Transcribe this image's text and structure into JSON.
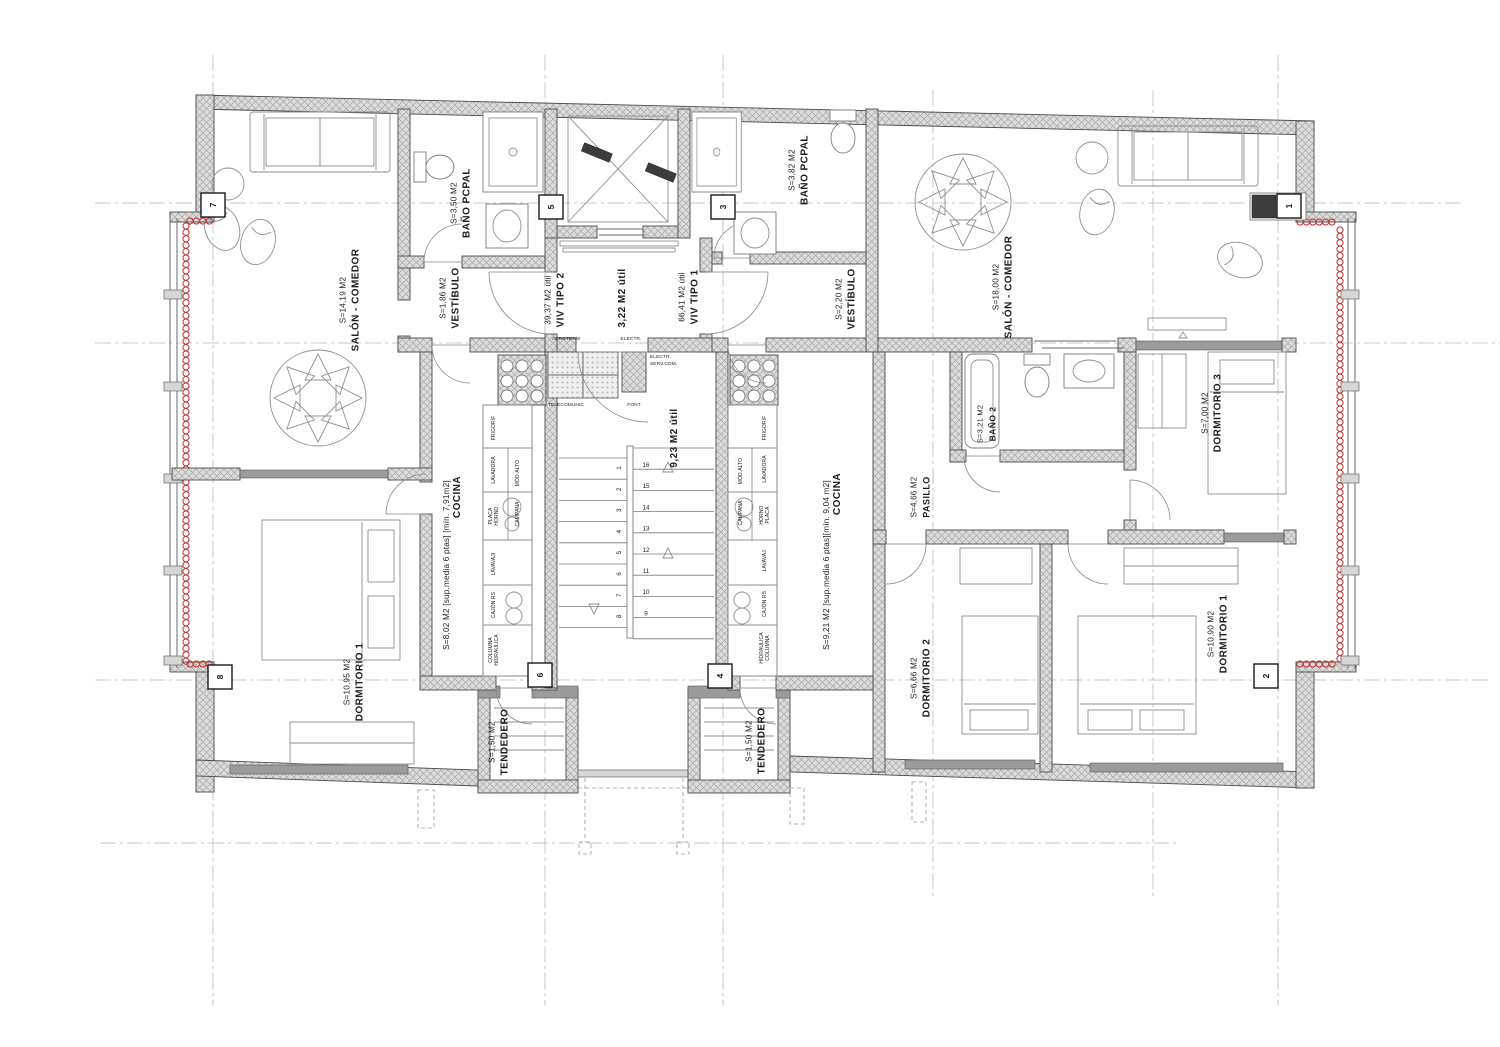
{
  "palette": {
    "background": "#ffffff",
    "wall_grey": "#dcdcdc",
    "line_grey": "#4a4a4a",
    "heating_red": "#c43c39",
    "axis_grey": "#b9b9b9"
  },
  "units": [
    {
      "type_label": "VIV TIPO 2",
      "type_area": "39,37 M2 útil"
    },
    {
      "type_label": "VIV TIPO 1",
      "type_area": "66,41 M2 útil"
    }
  ],
  "room_labels": [
    {
      "name": "SALÓN - COMEDOR",
      "area": "S=14,19 M2",
      "x": 352,
      "y": 300
    },
    {
      "name": "BAÑO PCPAL",
      "area": "S=3,50 M2",
      "x": 463,
      "y": 203
    },
    {
      "name": "VESTÍBULO",
      "area": "S=1,86 M2",
      "x": 452,
      "y": 298
    },
    {
      "name": "COCINA",
      "area": "",
      "x": 460,
      "y": 497
    },
    {
      "name": "",
      "area": "S=8,02 M2 [sup.media 6 ptas] [mín. 7,91m2]",
      "x": 449,
      "y": 565
    },
    {
      "name": "DORMITORIO 1",
      "area": "S=10,95 M2",
      "x": 356,
      "y": 682
    },
    {
      "name": "TENDEDERO",
      "area": "S=1,50 M2",
      "x": 501,
      "y": 742
    },
    {
      "name": "VIV TIPO 2",
      "area": "39,37 M2 útil",
      "x": 557,
      "y": 300
    },
    {
      "name": "3,22 M2 útil",
      "area": "",
      "x": 625,
      "y": 298
    },
    {
      "name": "VIV TIPO 1",
      "area": "66,41 M2 útil",
      "x": 691,
      "y": 297
    },
    {
      "name": "9,23 M2 útil",
      "area": "",
      "x": 677,
      "y": 438
    },
    {
      "name": "BAÑO PCPAL",
      "area": "S=3,82 M2",
      "x": 801,
      "y": 170
    },
    {
      "name": "VESTÍBULO",
      "area": "S=2,20 M2",
      "x": 848,
      "y": 299
    },
    {
      "name": "SALÓN - COMEDOR",
      "area": "S=18,00 M2",
      "x": 1005,
      "y": 287
    },
    {
      "name": "BAÑO 2",
      "area": "S=3,21 M2",
      "x": 989,
      "y": 424,
      "fs": 8.5
    },
    {
      "name": "PASILLO",
      "area": "S=4,66 M2",
      "x": 923,
      "y": 497,
      "fs": 9
    },
    {
      "name": "DORMITORIO 3",
      "area": "S=7,00 M2",
      "x": 1214,
      "y": 413
    },
    {
      "name": "COCINA",
      "area": "",
      "x": 840,
      "y": 494
    },
    {
      "name": "",
      "area": "S=9,21 M2 [sup.media 6 ptas][mín. 9,04 m2]",
      "x": 829,
      "y": 565
    },
    {
      "name": "DORMITORIO 2",
      "area": "S=6,66 M2",
      "x": 923,
      "y": 678
    },
    {
      "name": "DORMITORIO 1",
      "area": "S=10,90 M2",
      "x": 1220,
      "y": 634
    },
    {
      "name": "TENDEDERO",
      "area": "S=1,50 M2",
      "x": 758,
      "y": 741
    }
  ],
  "fixture_labels": [
    {
      "lines": [
        "FRIGORÍF"
      ],
      "x": 495,
      "y": 428
    },
    {
      "lines": [
        "LAVADORA"
      ],
      "x": 495,
      "y": 470
    },
    {
      "lines": [
        "PLACA",
        "HORNO"
      ],
      "x": 495,
      "y": 516
    },
    {
      "lines": [
        "MÓD.ALTO"
      ],
      "x": 519,
      "y": 473
    },
    {
      "lines": [
        "CAMPANA"
      ],
      "x": 519,
      "y": 514
    },
    {
      "lines": [
        "LAVAVAJI"
      ],
      "x": 495,
      "y": 564
    },
    {
      "lines": [
        "CAJÓN RS"
      ],
      "x": 495,
      "y": 605
    },
    {
      "lines": [
        "COLUMNA",
        "HIDRAULICA"
      ],
      "x": 495,
      "y": 650
    },
    {
      "lines": [
        "FRIGORÍF"
      ],
      "x": 766,
      "y": 428
    },
    {
      "lines": [
        "LAVADORA"
      ],
      "x": 766,
      "y": 469
    },
    {
      "lines": [
        "HORNO",
        "PLACA"
      ],
      "x": 766,
      "y": 515
    },
    {
      "lines": [
        "MÓD.ALTO"
      ],
      "x": 742,
      "y": 471
    },
    {
      "lines": [
        "CAMPANA"
      ],
      "x": 742,
      "y": 513
    },
    {
      "lines": [
        "LAVAVAJ."
      ],
      "x": 766,
      "y": 560
    },
    {
      "lines": [
        "CAJÓN RS"
      ],
      "x": 766,
      "y": 604
    },
    {
      "lines": [
        "HIDRAULICA",
        "COLUMNA"
      ],
      "x": 766,
      "y": 648
    }
  ],
  "closet_labels": [
    {
      "text": "AEROTERM",
      "x": 566,
      "y": 340
    },
    {
      "text": "ELECTR.",
      "x": 631,
      "y": 340
    },
    {
      "text": "TELECOMUNIC",
      "x": 566,
      "y": 406
    },
    {
      "text": "FONT",
      "x": 634,
      "y": 406
    },
    {
      "text": "ELECTR.",
      "x": 650,
      "y": 358,
      "anchor": "start"
    },
    {
      "text": "SERV.COM.",
      "x": 650,
      "y": 365,
      "anchor": "start"
    }
  ],
  "stairs": {
    "left": [
      "1",
      "2",
      "3",
      "4",
      "5",
      "6",
      "7",
      "8"
    ],
    "right": [
      "16",
      "15",
      "14",
      "13",
      "12",
      "11",
      "10",
      "9"
    ]
  },
  "markers": [
    {
      "n": "7",
      "x": 213,
      "y": 205
    },
    {
      "n": "5",
      "x": 551,
      "y": 207
    },
    {
      "n": "3",
      "x": 723,
      "y": 207
    },
    {
      "n": "1",
      "x": 1289,
      "y": 206
    },
    {
      "n": "8",
      "x": 220,
      "y": 677
    },
    {
      "n": "6",
      "x": 540,
      "y": 675
    },
    {
      "n": "4",
      "x": 720,
      "y": 676
    },
    {
      "n": "2",
      "x": 1266,
      "y": 676
    }
  ]
}
